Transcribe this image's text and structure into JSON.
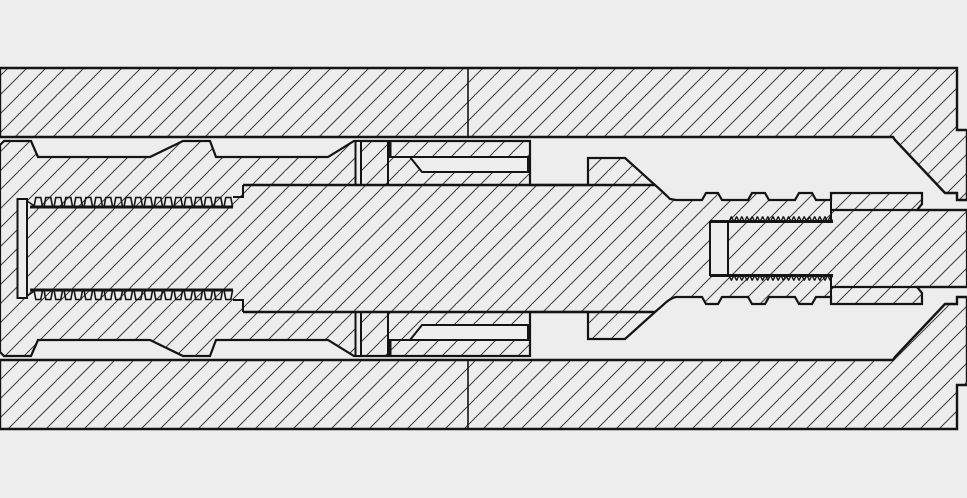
{
  "meta": {
    "title": "Downhole tool threaded assembly — longitudinal cross-section CAD drawing",
    "canvas": {
      "width": 967,
      "height": 498
    }
  },
  "colors": {
    "background": "#ededed",
    "outline": "#141414",
    "hatch_line": "#3c3c3c"
  },
  "hatch": {
    "spacing": 19,
    "angle_dir": "bottom-left-to-top-right",
    "line_width": 1
  },
  "drawing": {
    "shapes": [
      {
        "name": "background",
        "type": "rect",
        "x": 0,
        "y": 0,
        "w": 967,
        "h": 498,
        "fill": "bg",
        "sw": 0
      },
      {
        "name": "outer-housing-upper",
        "type": "path",
        "fill": "hatch",
        "sw": 2.4,
        "d": "M0,68 L957,68 L957,130 L967,130 L967,200 L957,200 L957,193 L945,193 L895,140 L893,137 L0,137 Z"
      },
      {
        "name": "outer-housing-lower",
        "type": "path",
        "fill": "hatch",
        "sw": 2.4,
        "d": "M0,429 L957,429 L957,385 L967,385 L967,297 L957,297 L957,304 L945,304 L895,357 L893,360 L0,360 Z"
      },
      {
        "name": "inner-mandrel-assembly",
        "type": "path",
        "fill": "hatch",
        "sw": 2.2,
        "d": "M0,145 L4,141 L31,141 L38,157 L150,157 L183,141 L210,141 L216,157 L328,157 L354,141 L388,141 L530,141 L530,185 L588,185 L588,158 L625,158 L655,185 Q662,191 670,199 L676,200 L702,200 L706,193 L718,193 L722,200 L748,200 L752,193 L765,193 L769,200 L795,200 L799,193 L812,193 L816,200 L831,200 L831,193 L922,193 L922,204 L917,210 L967,210 L967,287 L917,287 L922,293 L922,304 L831,304 L831,297 L816,297 L812,304 L799,304 L795,297 L769,297 L765,304 L752,304 L748,297 L722,297 L718,304 L706,304 L702,297 L676,297 Q670,298 662,306 L655,312 L625,339 L588,339 L588,312 L530,312 L530,356 L388,356 L354,356 L328,340 L216,340 L210,356 L183,356 L150,340 L38,340 L31,356 L4,356 L0,352 Z"
      },
      {
        "name": "body-face-gap-upper",
        "type": "path",
        "fill": "bg",
        "sw": 2,
        "d": "M355.5,141 L361,141 L361,185 L355.5,185 Z"
      },
      {
        "name": "body-face-gap-lower",
        "type": "path",
        "fill": "bg",
        "sw": 2,
        "d": "M355.5,312 L361,312 L361,356 L355.5,356 Z"
      },
      {
        "name": "sleeve-clearance-slot-upper",
        "type": "path",
        "fill": "bg",
        "sw": 2,
        "d": "M410,157 L528,157 L528,172 L422,172 Z"
      },
      {
        "name": "sleeve-clearance-slot-lower",
        "type": "path",
        "fill": "bg",
        "sw": 2,
        "d": "M410,340 L528,340 L528,325 L422,325 Z"
      },
      {
        "name": "left-pin-nose-gap",
        "type": "path",
        "fill": "bg",
        "sw": 2,
        "d": "M17.5,199 L27,199 L27,298 L17.5,298 Z"
      },
      {
        "name": "right-pin-nose-gap",
        "type": "path",
        "fill": "bg",
        "sw": 2,
        "d": "M710,222 L728,222 L728,275 L710,275 Z"
      },
      {
        "name": "housing-joint-line-upper",
        "type": "path",
        "fill": "none",
        "sw": 1.6,
        "d": "M468,68 L468,137"
      },
      {
        "name": "housing-joint-line-lower",
        "type": "path",
        "fill": "none",
        "sw": 1.6,
        "d": "M468,360 L468,429"
      },
      {
        "name": "mandrel-surface-line-upper",
        "type": "path",
        "fill": "none",
        "sw": 2.6,
        "d": "M243,185 L655,185"
      },
      {
        "name": "mandrel-surface-line-lower",
        "type": "path",
        "fill": "none",
        "sw": 2.6,
        "d": "M243,312 L655,312"
      },
      {
        "name": "mandrel-step-upper",
        "type": "path",
        "fill": "none",
        "sw": 2,
        "d": "M233,197 L243,197 L243,185"
      },
      {
        "name": "mandrel-step-lower",
        "type": "path",
        "fill": "none",
        "sw": 2,
        "d": "M233,300 L243,300 L243,312"
      },
      {
        "name": "gland-nut-face-lines",
        "type": "path",
        "fill": "none",
        "sw": 2,
        "d": "M388,141 L388,186 M388,311 L388,356"
      },
      {
        "name": "sleeve-end-lug",
        "type": "path",
        "fill": "none",
        "sw": 3,
        "d": "M390,141 L390,158 M390,356 L390,339"
      },
      {
        "name": "sleeve-underside-lines",
        "type": "path",
        "fill": "none",
        "sw": 2,
        "d": "M388,157 L411,157 M388,340 L411,340"
      },
      {
        "name": "box-rim-face-lines",
        "type": "path",
        "fill": "none",
        "sw": 2,
        "d": "M831,193 L831,222 M831,275 L831,304"
      },
      {
        "name": "right-rod-surface-lines",
        "type": "path",
        "fill": "none",
        "sw": 2.2,
        "d": "M831,210 L967,210 M831,287 L967,287"
      },
      {
        "name": "pin-nose-chamfer-lines",
        "type": "path",
        "fill": "none",
        "sw": 1.5,
        "d": "M27,201 L36,207 M27,296 L36,290"
      },
      {
        "name": "left-thread-root-upper",
        "type": "path",
        "fill": "none",
        "sw": 3,
        "d": "M30,207 L233,207"
      },
      {
        "name": "left-thread-root-lower",
        "type": "path",
        "fill": "none",
        "sw": 3,
        "d": "M30,290 L233,290"
      },
      {
        "name": "right-thread-root-upper",
        "type": "path",
        "fill": "none",
        "sw": 3,
        "d": "M710,221.5 L833,221.5"
      },
      {
        "name": "right-thread-root-lower",
        "type": "path",
        "fill": "none",
        "sw": 3,
        "d": "M710,275.5 L833,275.5"
      },
      {
        "name": "left-thread-crests-upper",
        "type": "threads",
        "sw": 1.6,
        "x0": 34,
        "x1": 230,
        "pitch": 10,
        "tooth_w": 5,
        "rise": 1.8,
        "root_y": 207,
        "crest_y": 197.5
      },
      {
        "name": "left-thread-crests-lower",
        "type": "threads",
        "sw": 1.6,
        "x0": 34,
        "x1": 230,
        "pitch": 10,
        "tooth_w": 5,
        "rise": 1.8,
        "root_y": 290,
        "crest_y": 299.5
      },
      {
        "name": "right-thread-crests-upper",
        "type": "threads",
        "sw": 1.4,
        "x0": 729,
        "x1": 831,
        "pitch": 5.2,
        "tooth_w": 0.4,
        "rise": 2.2,
        "root_y": 221.5,
        "crest_y": 217
      },
      {
        "name": "right-thread-crests-lower",
        "type": "threads",
        "sw": 1.4,
        "x0": 729,
        "x1": 831,
        "pitch": 5.2,
        "tooth_w": 0.4,
        "rise": 2.2,
        "root_y": 275.5,
        "crest_y": 280
      }
    ]
  }
}
